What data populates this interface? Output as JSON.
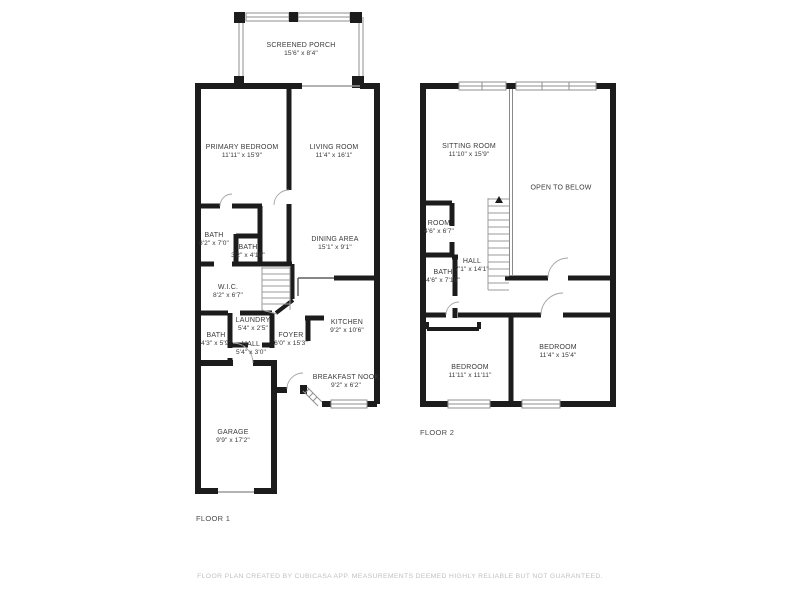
{
  "colors": {
    "background": "#ffffff",
    "wall": "#1c1c1c",
    "room_label": "#3a3a3a",
    "floor_label": "#4a4a4a",
    "disclaimer": "#c1c1c1",
    "stairs": "#9b9b9b",
    "window_outline": "#8f8f8f"
  },
  "floor1": {
    "label": "FLOOR 1",
    "rooms": [
      {
        "name": "SCREENED PORCH",
        "dims": "15'6\" x 8'4\""
      },
      {
        "name": "PRIMARY BEDROOM",
        "dims": "11'11\" x 15'9\""
      },
      {
        "name": "LIVING ROOM",
        "dims": "11'4\" x 16'1\""
      },
      {
        "name": "BATH",
        "dims": "8'2\" x 7'0\""
      },
      {
        "name": "BATH",
        "dims": "3'2\" x 4'10\""
      },
      {
        "name": "DINING AREA",
        "dims": "15'1\" x 9'1\""
      },
      {
        "name": "W.I.C.",
        "dims": "8'2\" x 6'7\""
      },
      {
        "name": "LAUNDRY",
        "dims": "5'4\" x 2'5\""
      },
      {
        "name": "BATH",
        "dims": "4'3\" x 5'9\""
      },
      {
        "name": "HALL",
        "dims": "5'4\" x 3'0\""
      },
      {
        "name": "FOYER",
        "dims": "6'0\" x 15'3\""
      },
      {
        "name": "KITCHEN",
        "dims": "9'2\" x 10'6\""
      },
      {
        "name": "BREAKFAST NOOK",
        "dims": "9'2\" x 6'2\""
      },
      {
        "name": "GARAGE",
        "dims": "9'9\" x 17'2\""
      }
    ]
  },
  "floor2": {
    "label": "FLOOR 2",
    "rooms": [
      {
        "name": "SITTING ROOM",
        "dims": "11'10\" x 15'9\""
      },
      {
        "name": "OPEN TO BELOW",
        "dims": ""
      },
      {
        "name": "ROOM",
        "dims": "4'6\" x 6'7\""
      },
      {
        "name": "HALL",
        "dims": "7'1\" x 14'1\""
      },
      {
        "name": "BATH",
        "dims": "4'6\" x 7'10\""
      },
      {
        "name": "BEDROOM",
        "dims": "11'11\" x 11'11\""
      },
      {
        "name": "BEDROOM",
        "dims": "11'4\" x 15'4\""
      }
    ]
  },
  "footer": {
    "disclaimer": "FLOOR PLAN CREATED BY CUBICASA APP. MEASUREMENTS DEEMED HIGHLY RELIABLE BUT NOT GUARANTEED."
  }
}
